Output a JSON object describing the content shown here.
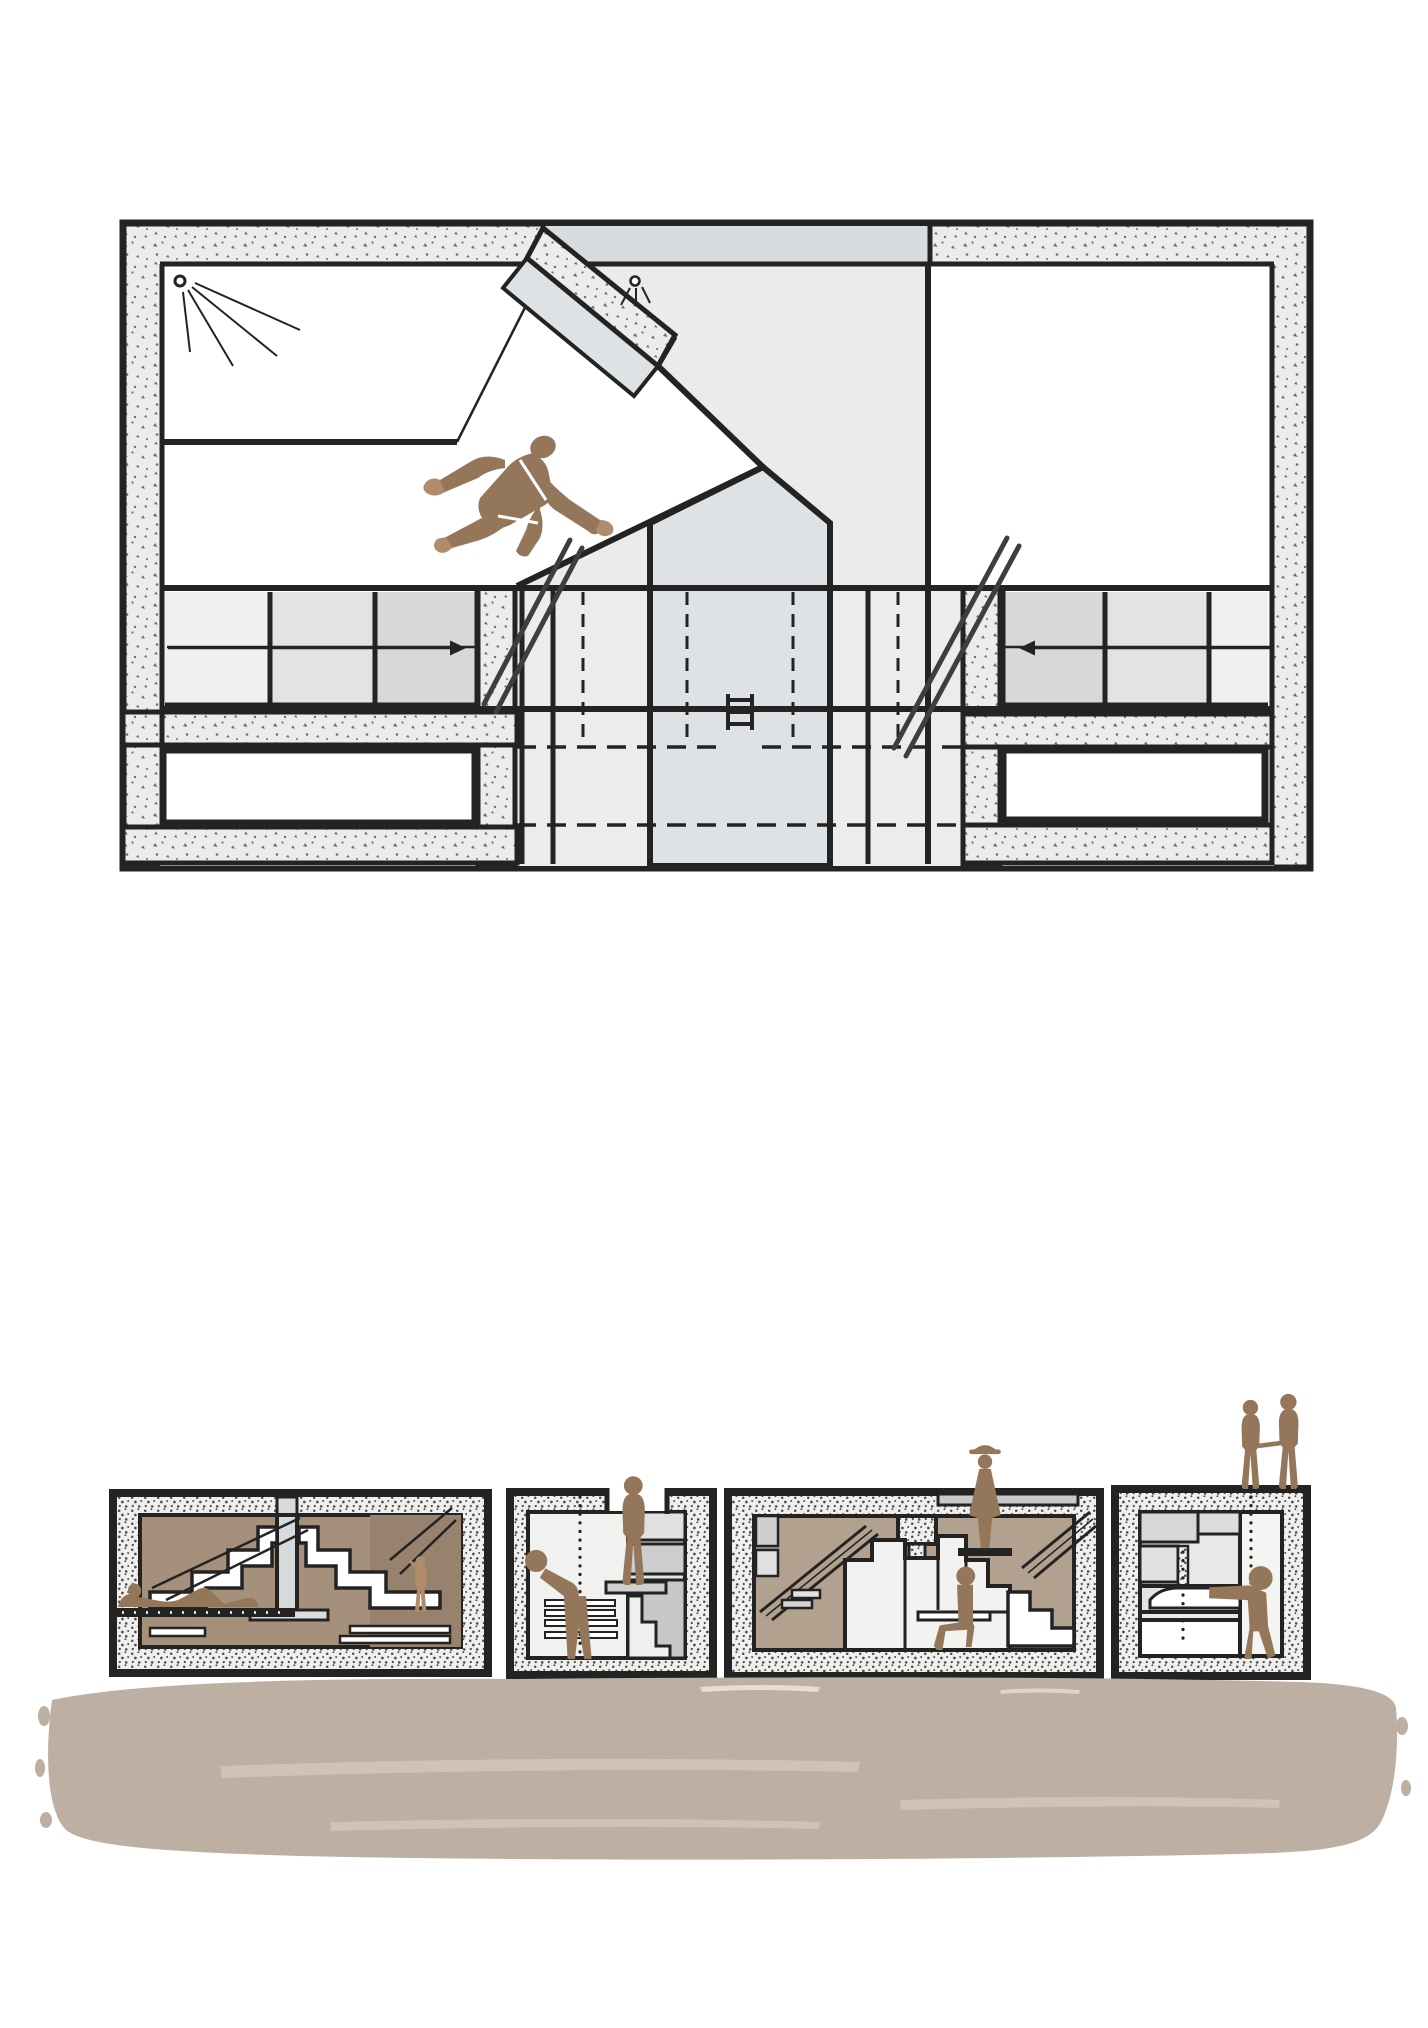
{
  "meta": {
    "title": "Architectural drawing: sectional plan of a concrete dwelling with pivoting wall, and four cross-sections standing on painted ground",
    "kind": "line drawing, no text labels"
  },
  "palette": {
    "ink": "#232323",
    "paper": "#ffffff",
    "plan_wall_fill": "#ececec",
    "plan_speck": "#6f6f6f",
    "section_wall_fill": "#efefed",
    "section_speck": "#4e4e4e",
    "void_gray": "#e9ebed",
    "pentagon_gray": "#dfe2e4",
    "top_wall_gray": "#d9dcde",
    "hall_gray": "#eaecee",
    "cell_light": "#eef0f1",
    "cell_mid": "#e1e3e5",
    "cell_dark": "#d6d8da",
    "ladder_gray": "#3e3e3e",
    "figure_brown": "#94765a",
    "figure_brown_light": "#b18c6a",
    "section1_bg": "#a5907b",
    "section1_bg_dark": "#97826d",
    "section3_bg": "#b3a190",
    "panel_gray": "#d8d9d9",
    "ground_tan": "#bdafa2",
    "ground_streak": "#cfc3b7"
  },
  "plan": {
    "description": "plan with concrete speckled walls, pivoting wall leaf near top, white diagonal corridor with sleeping figure, storage grid bands with direction arrows, two ladders, lower rooms",
    "figure_pose": "person lying spread-eagle seen from above",
    "arrows": [
      {
        "id": "left-band-arrow",
        "direction": "right"
      },
      {
        "id": "right-band-arrow",
        "direction": "left"
      }
    ],
    "lamp_count": 2,
    "ladder_count": 2
  },
  "sections": [
    {
      "id": "section-1",
      "figures": [
        "person reclining on ledge",
        "small person climbing steps"
      ]
    },
    {
      "id": "section-2",
      "figures": [
        "person bending forward",
        "person standing in roof opening"
      ]
    },
    {
      "id": "section-3",
      "figures": [
        "person standing at stair",
        "person seated on bench",
        "person with hat in roof opening"
      ]
    },
    {
      "id": "section-4",
      "figures": [
        "person seated on high ledge",
        "couple holding hands on roof"
      ]
    }
  ],
  "ground": {
    "description": "broad painted earth swath under the four sections"
  }
}
